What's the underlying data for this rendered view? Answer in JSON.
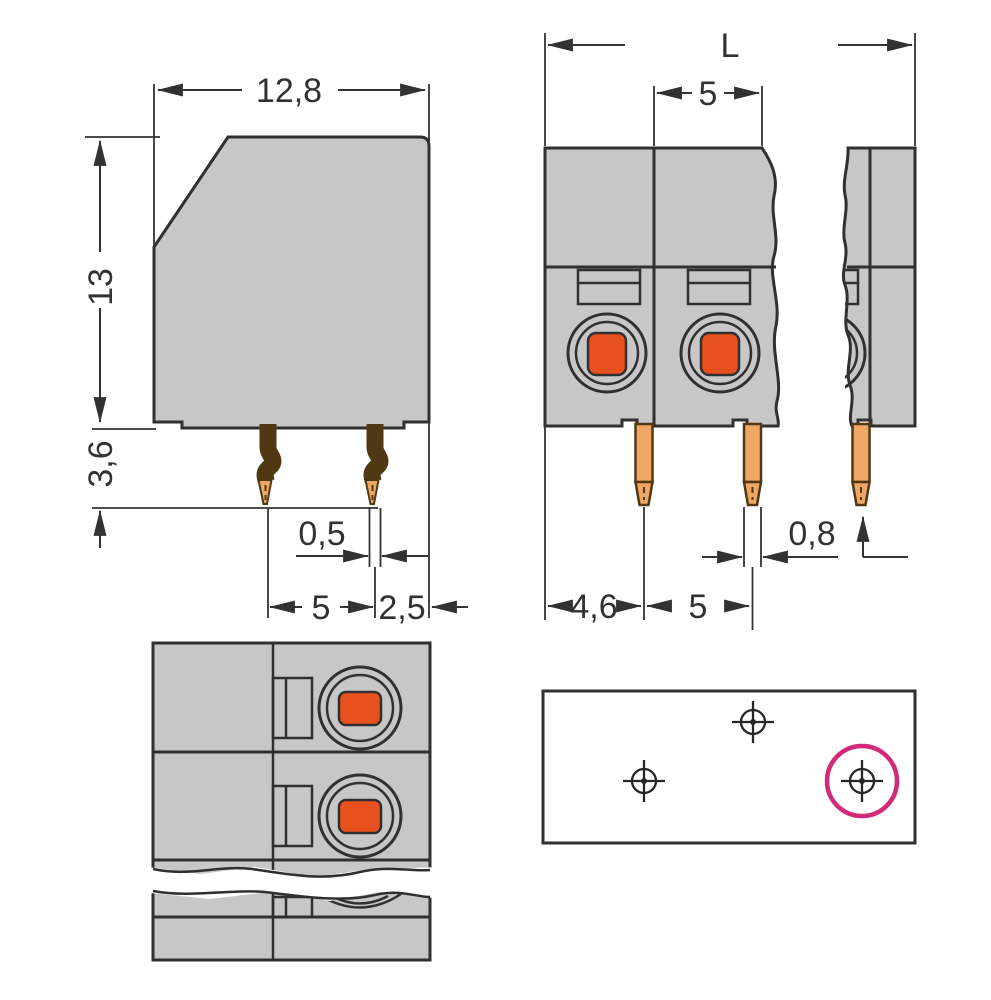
{
  "drawing": {
    "side_view": {
      "width": "12,8",
      "height": "13",
      "pin_length": "3,6",
      "pin_width": "0,5",
      "pin_pitch": "5",
      "pin_edge": "2,5"
    },
    "front_view": {
      "length": "L",
      "pole_pitch": "5",
      "edge_to_pin": "4,6",
      "pin_pitch": "5",
      "pin_width": "0,8"
    },
    "top_view": {},
    "drilling_plan": {
      "hole_marks": 3
    }
  },
  "colors": {
    "paper": "#ffffff",
    "body": "#c7c7c7",
    "outline": "#303030",
    "dim": "#323232",
    "copper": "#f0a766",
    "copper-edge": "#503813",
    "button": "#e8501e",
    "magenta": "#d02a78"
  }
}
